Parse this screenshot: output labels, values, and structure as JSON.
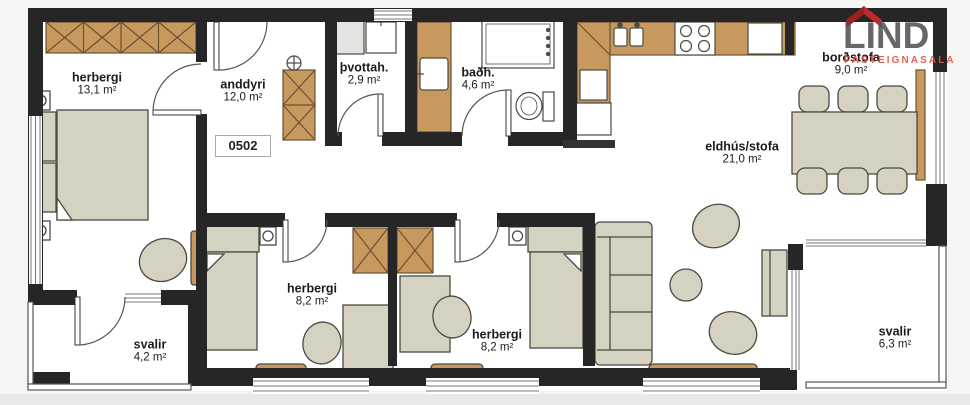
{
  "unit_label": "0502",
  "rooms": [
    {
      "name": "herbergi",
      "area": "13,1 m²"
    },
    {
      "name": "anddyri",
      "area": "12,0 m²"
    },
    {
      "name": "þvottah.",
      "area": "2,9 m²"
    },
    {
      "name": "baðh.",
      "area": "4,6 m²"
    },
    {
      "name": "borðstofa",
      "area": "9,0 m²"
    },
    {
      "name": "eldhús/stofa",
      "area": "21,0 m²"
    },
    {
      "name": "herbergi",
      "area": "8,2 m²"
    },
    {
      "name": "herbergi",
      "area": "8,2 m²"
    },
    {
      "name": "svalir",
      "area": "4,2 m²"
    },
    {
      "name": "svalir",
      "area": "6,3 m²"
    }
  ],
  "logo": {
    "brand": "LIND",
    "tagline": "FASTEIGNASALA",
    "brand_color": "#50505a",
    "tagline_color": "#e0564a",
    "house_color": "#c8292a"
  },
  "colors": {
    "wall": "#262626",
    "wood_cabinet": "#c8995e",
    "furniture": "#d6d2c2",
    "floor": "#ffffff",
    "window_line": "#777777"
  },
  "icons": {
    "house-roof-icon": "red chevron roof",
    "stove-icon": "4 burner circles",
    "kitchen-sink-icon": "double bowl",
    "fridge-icon": "white box",
    "washer-icon": "white box with tap",
    "bathroom-sink-icon": "basin on counter",
    "toilet-icon": "bowl with tank",
    "shower-icon": "square tray",
    "ceiling-fixture-icon": "circle with cross"
  }
}
